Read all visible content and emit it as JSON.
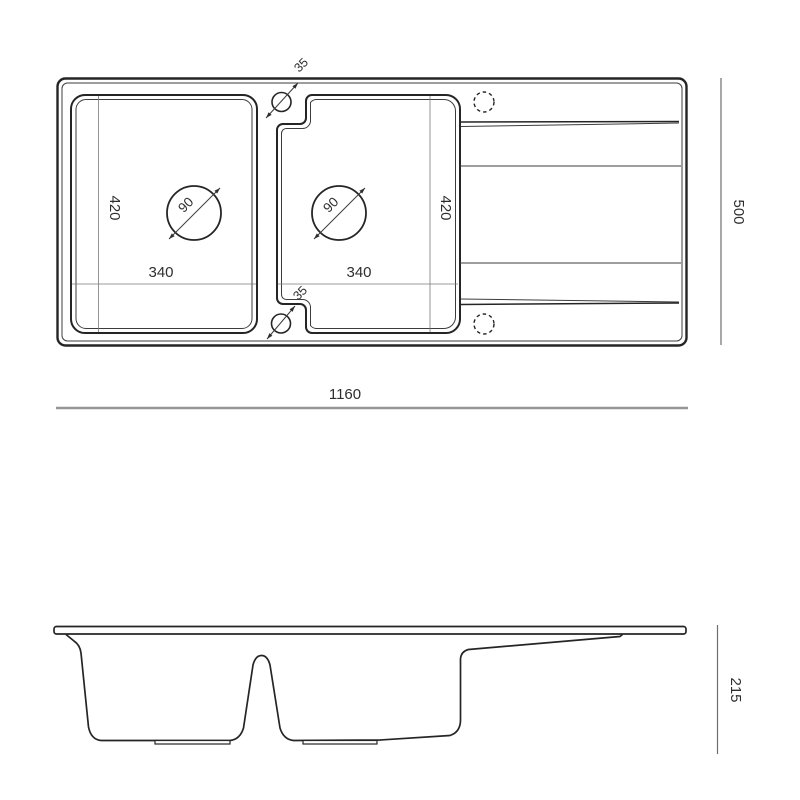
{
  "drawing": {
    "type": "kitchen sink technical dimension drawing",
    "background_color": "#ffffff",
    "outline_color": "#252525",
    "dimension_line_color": "#8f8f8f",
    "text_color": "#2e2e2e",
    "top_view": {
      "overall_width": "1160",
      "overall_depth": "500",
      "left_bowl": {
        "width": "340",
        "depth": "420",
        "drain_diameter": "90"
      },
      "right_bowl": {
        "width": "340",
        "depth": "420",
        "drain_diameter": "90"
      },
      "overflow_hole_top": "35",
      "overflow_hole_bottom": "35"
    },
    "side_view": {
      "height": "215"
    }
  }
}
